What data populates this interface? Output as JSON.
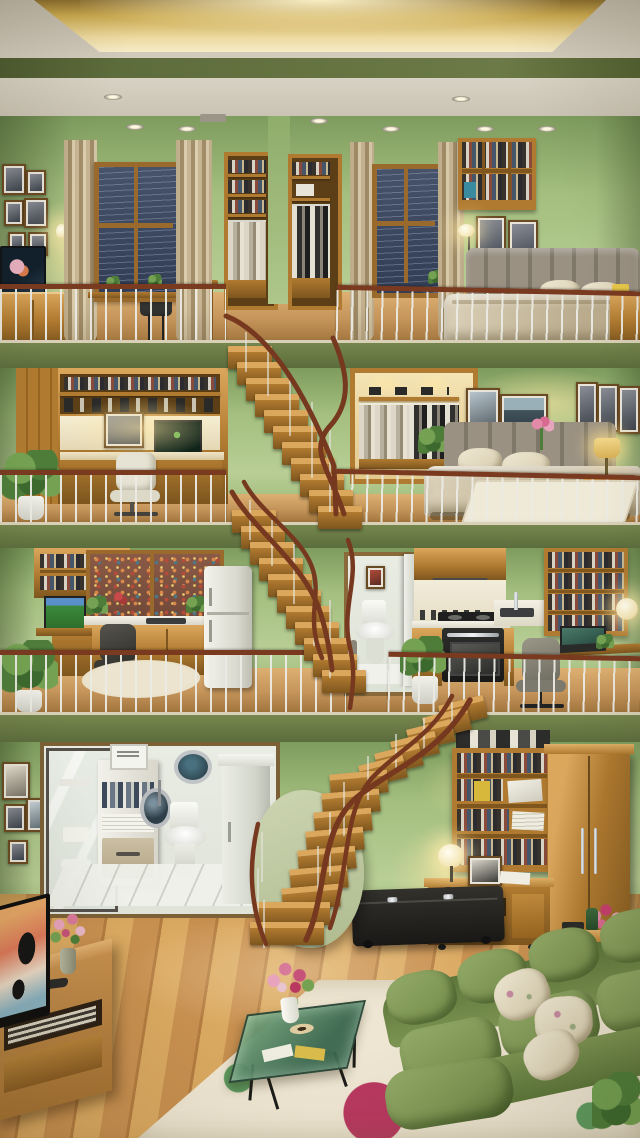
{
  "meta": {
    "type": "interior-render",
    "description": "Isometric cross-section dollhouse view of a four-level apartment: green walls, warm wood furniture, and open staircases with red-brown handrails connecting every level.",
    "width": 640,
    "height": 1138
  },
  "palette": {
    "gold": "#c9a84e",
    "goldL": "#f2e3ae",
    "ceil": "#d3ccbd",
    "ceilD": "#b2ab9c",
    "beam": "#5d6c3b",
    "slab": "#75864d",
    "slabD": "#596a3b",
    "wall": "#a4bf7f",
    "wallLight": "#b8ce95",
    "wallDark": "#7e9c5e",
    "wood": "#b07a30",
    "woodL": "#dba75d",
    "woodD": "#7e561e",
    "floorTan": "#c4945a",
    "floorTanL": "#ddb072",
    "floorTanD": "#a2763e",
    "curtain": "#cdbb99",
    "curtainD": "#a6926d",
    "rail": "#7a3a20",
    "headboard": "#9a9183",
    "linen": "#dcd2ba",
    "linenD": "#b9ab8c",
    "white": "#f0efe8",
    "tile": "#edefe9",
    "sofa": "#7d9553",
    "sofaD": "#5c763a",
    "sofaL": "#93aa68",
    "rugBase": "#eee6d2",
    "pink": "#c6406e",
    "pinkL": "#e28aa8",
    "leaf": "#4e7d3a",
    "leafL": "#74a252",
    "glass": "#4e8058",
    "dark": "#23211e",
    "nightWindow": "#46536b",
    "cityWindow": "#8a5a46",
    "lampGlow": "#ffe9ad"
  },
  "scene": {
    "ceiling": {
      "label": "Coffered ceiling with warm gold cove lighting and recessed spotlights"
    },
    "floors": [
      {
        "id": "level-4",
        "label": "Top level: study and bedroom — rainy night windows with beige curtains, built-in book and wardrobe niches, TV cabinet, writing desk, grey upholstered bed",
        "objects": [
          "picture-frames",
          "wall-sconce",
          "tv",
          "cabinet",
          "desk",
          "chair",
          "window-night",
          "curtains",
          "bookshelf-niche",
          "wardrobe-niche",
          "wall-shelf",
          "floor-lamp",
          "bed",
          "nightstand",
          "railing"
        ]
      },
      {
        "id": "level-3",
        "label": "Third level: built-in home office nook with lit shelving and white chair, potted plant, lit wardrobe niche with hanging clothes, bedroom with grey headboard bed, art frames, lamp nightstand and white rug",
        "objects": [
          "office-nook",
          "monitor",
          "office-chair",
          "plant",
          "wardrobe-niche",
          "bed",
          "picture-frames",
          "nightstand",
          "table-lamp",
          "rug",
          "railing"
        ]
      },
      {
        "id": "level-2",
        "label": "Second level: workspace with autumn city window, kitchen counters with sink and fridge, small bathroom with toilet, gas cooktop and oven, book wall with laptop desk and glowing wall lamp",
        "objects": [
          "monitor",
          "desk",
          "office-chair",
          "window-city",
          "kitchen-counter",
          "fridge",
          "oval-rug",
          "plant",
          "bathroom",
          "toilet",
          "range-hood",
          "cooktop",
          "oven",
          "sink",
          "bookshelf",
          "laptop",
          "wall-lamp",
          "railing"
        ]
      },
      {
        "id": "level-1",
        "label": "Ground level: laundry bathroom with glass door, binder shelf, washer porthole, toilet and tiled floor; library shelf and tall wardrobe; desk with globe lamp; living room with TV console, floral rug, green glass coffee table with flowers and green leather sofa with cream pillows",
        "objects": [
          "glass-door",
          "shelf-unit",
          "washing-machine",
          "porthole-window",
          "toilet",
          "tile-floor",
          "white-cabinet",
          "bookshelf",
          "wardrobe",
          "desk",
          "globe-lamp",
          "telephone",
          "storage-ottoman",
          "flower-bouquet",
          "tv",
          "tv-console",
          "wood-floor",
          "floral-rug",
          "coffee-table",
          "flower-vase",
          "sofa",
          "cushions",
          "plant"
        ]
      }
    ],
    "stairs": {
      "label": "Open wooden staircases with thin metal balusters and curved red-brown handrails linking all four levels"
    }
  }
}
